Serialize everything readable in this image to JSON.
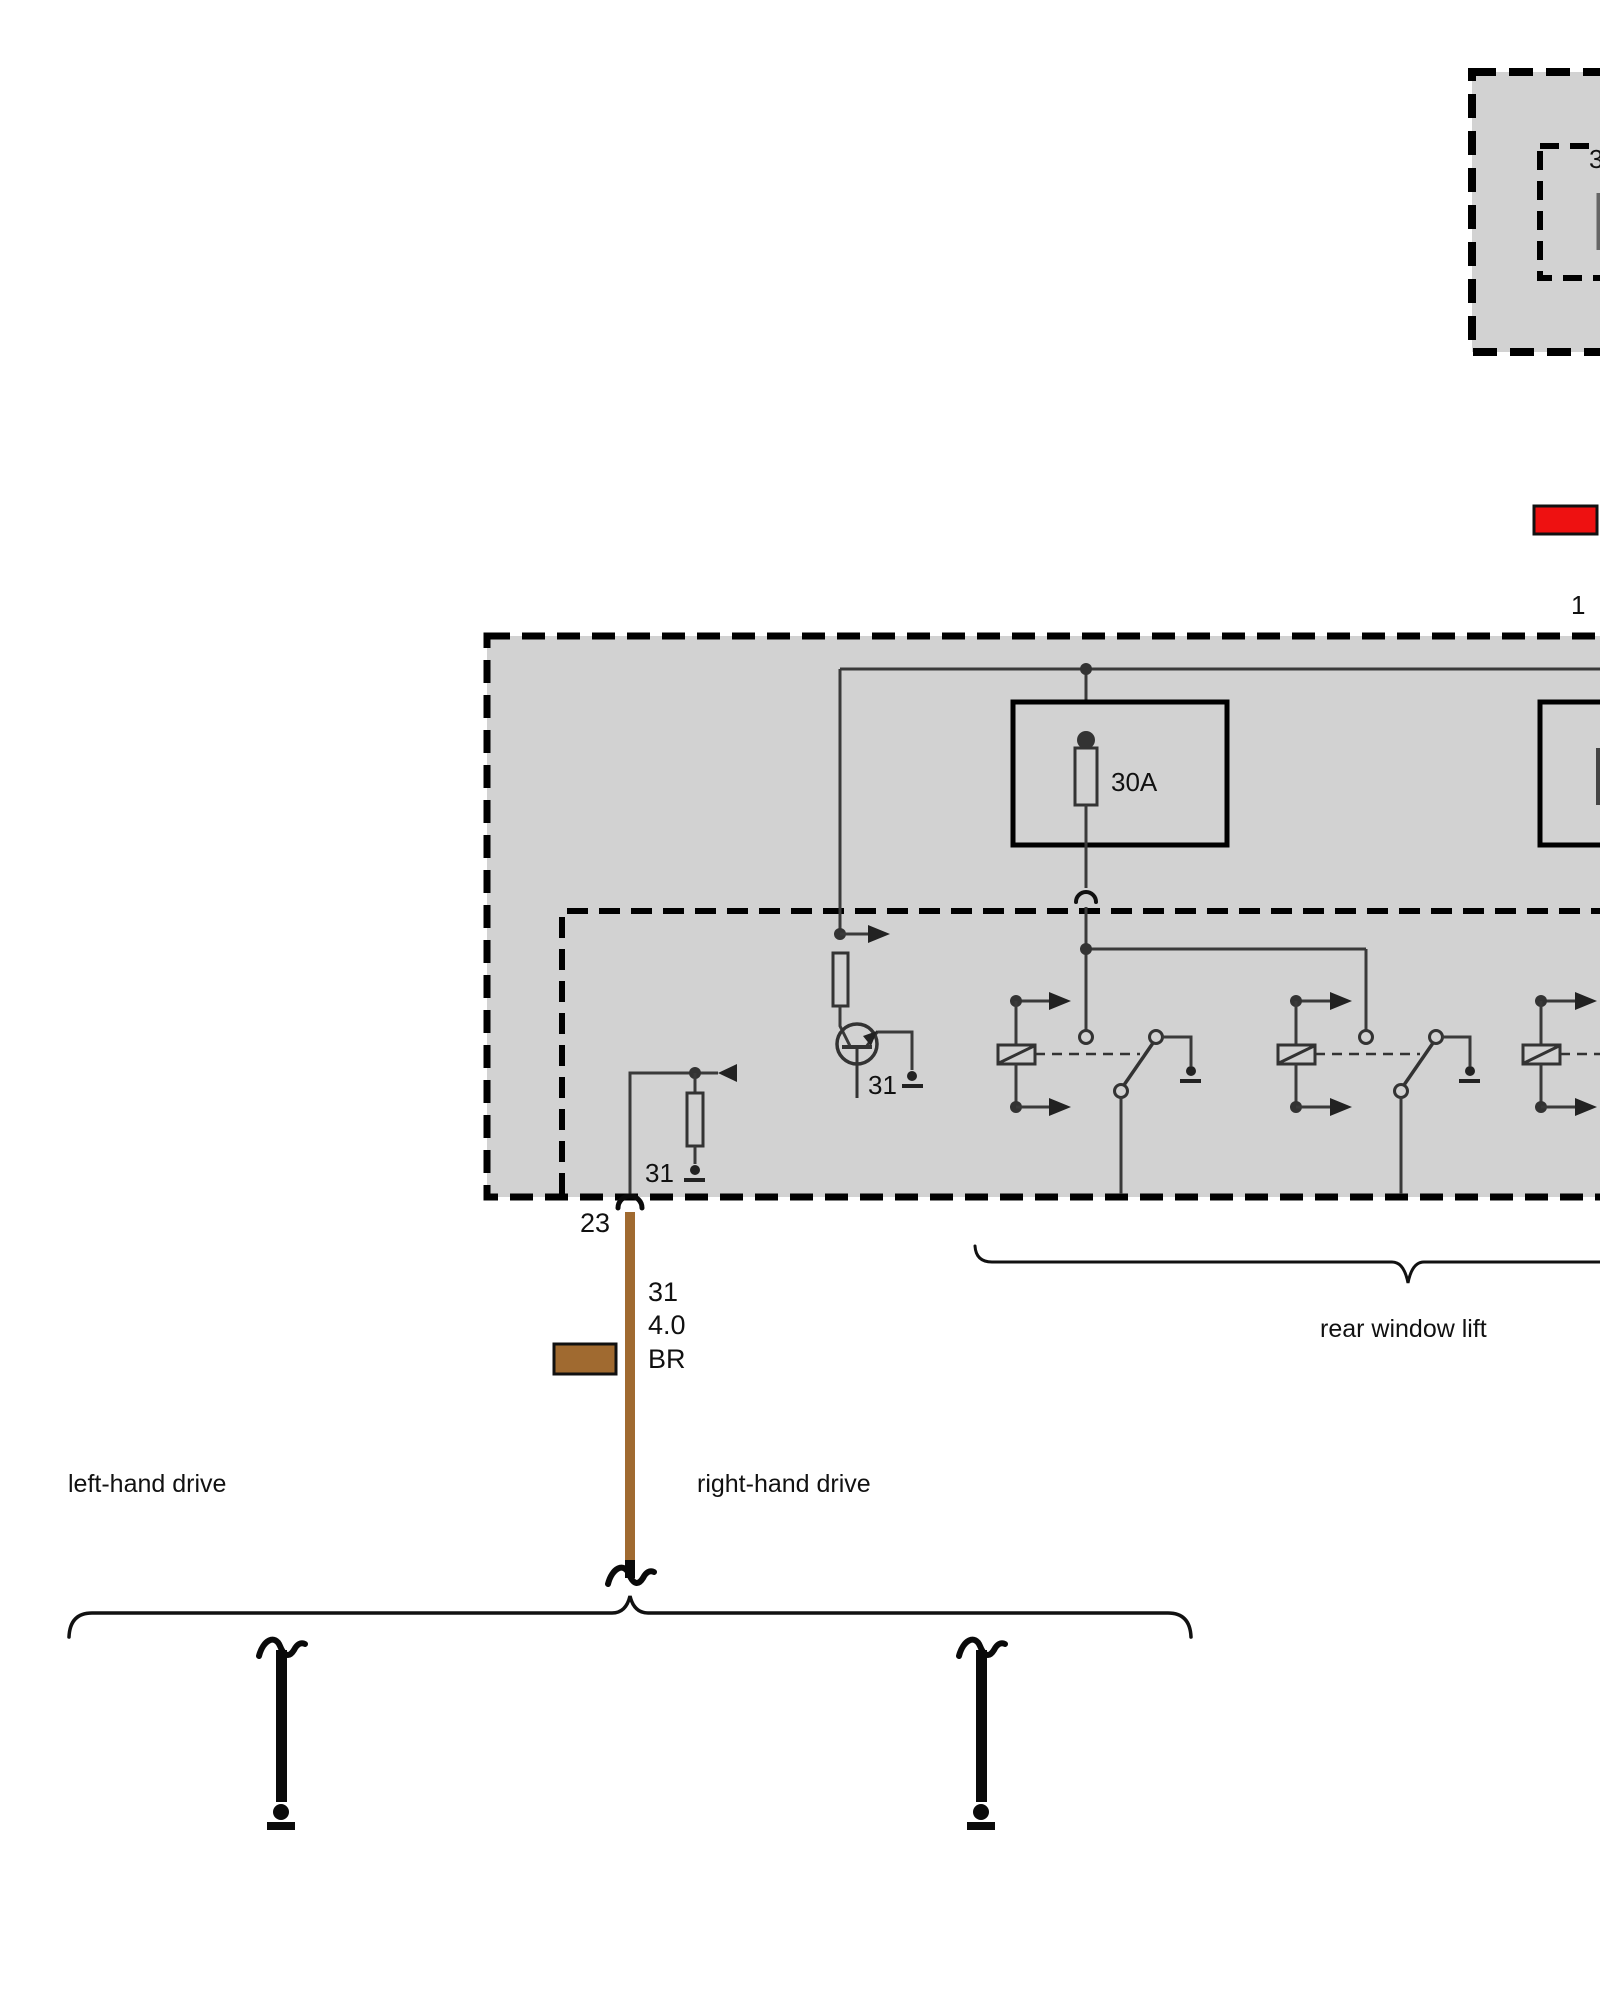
{
  "colors": {
    "box_fill": "#D2D2D2",
    "wire": "#3A3A3A",
    "black": "#0A0A0A",
    "brown": "#A06A30",
    "red": "#EE1111",
    "text": "#111111"
  },
  "control_unit_top": {
    "pin3_label": "3"
  },
  "terminals": {
    "pin1_label": "1",
    "ground_label": "31",
    "pin23_label": "23"
  },
  "fuses": {
    "fuse1_rating": "30A"
  },
  "wire_markers": {
    "terminal": "31",
    "cross_section": "4.0",
    "color_code": "BR"
  },
  "captions": {
    "left_hand_drive": "left-hand drive",
    "right_hand_drive": "right-hand drive",
    "rear_window_lift": "rear window lift"
  }
}
